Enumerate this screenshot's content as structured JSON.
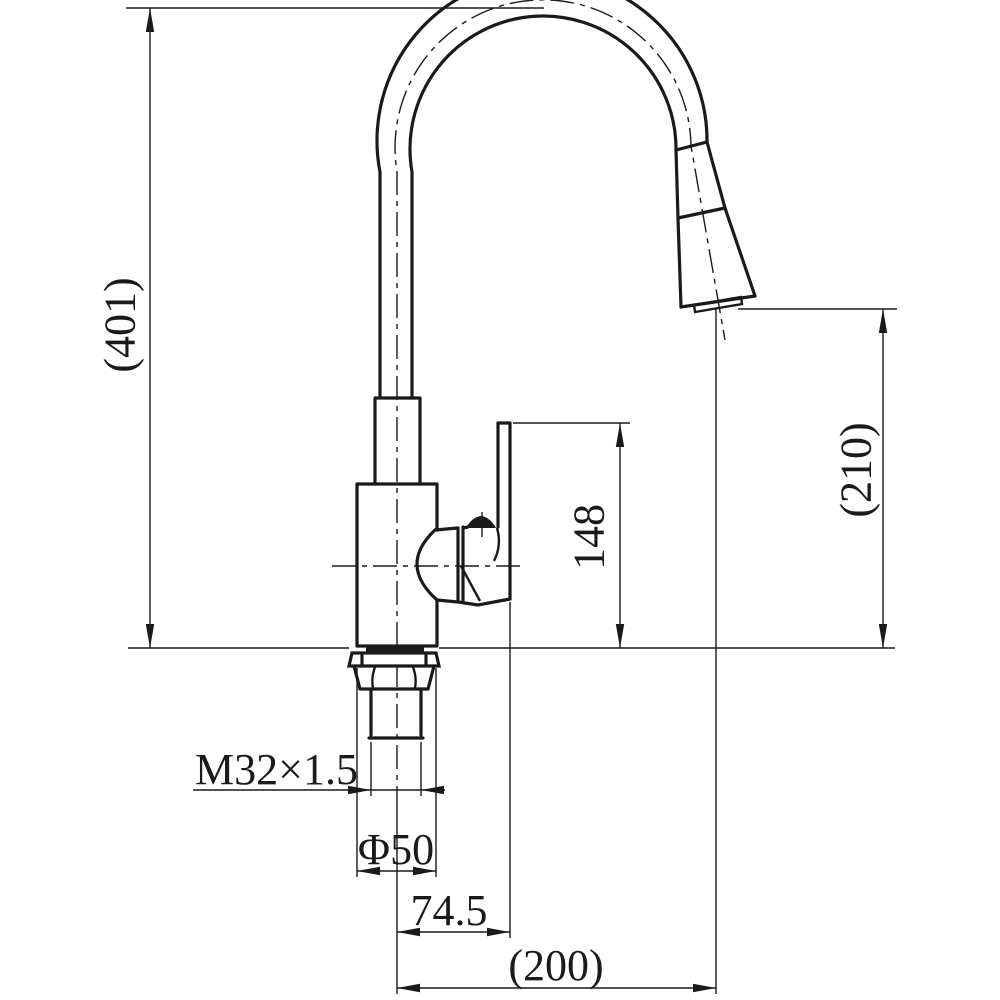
{
  "meta": {
    "description": "Engineering dimension drawing of a single-handle pull-down kitchen faucet, side view"
  },
  "colors": {
    "background": "#ffffff",
    "ink": "#1a1a1a"
  },
  "dims": {
    "total_height": {
      "label": "(401)",
      "meaning": "overall height of faucet from mounting surface to top of spout arc"
    },
    "outlet_height": {
      "label": "(210)",
      "meaning": "height from mounting surface to spray outlet"
    },
    "handle_height": {
      "label": "148",
      "meaning": "height from mounting surface to top of handle lever"
    },
    "thread": {
      "label": "M32×1.5",
      "meaning": "mounting shank thread specification"
    },
    "base_diameter": {
      "label": "Φ50",
      "meaning": "base flange diameter"
    },
    "center_to_handle": {
      "label": "74.5",
      "meaning": "horizontal distance from faucet centerline to handle edge"
    },
    "reach": {
      "label": "(200)",
      "meaning": "horizontal distance from faucet centerline to spray outlet"
    }
  }
}
